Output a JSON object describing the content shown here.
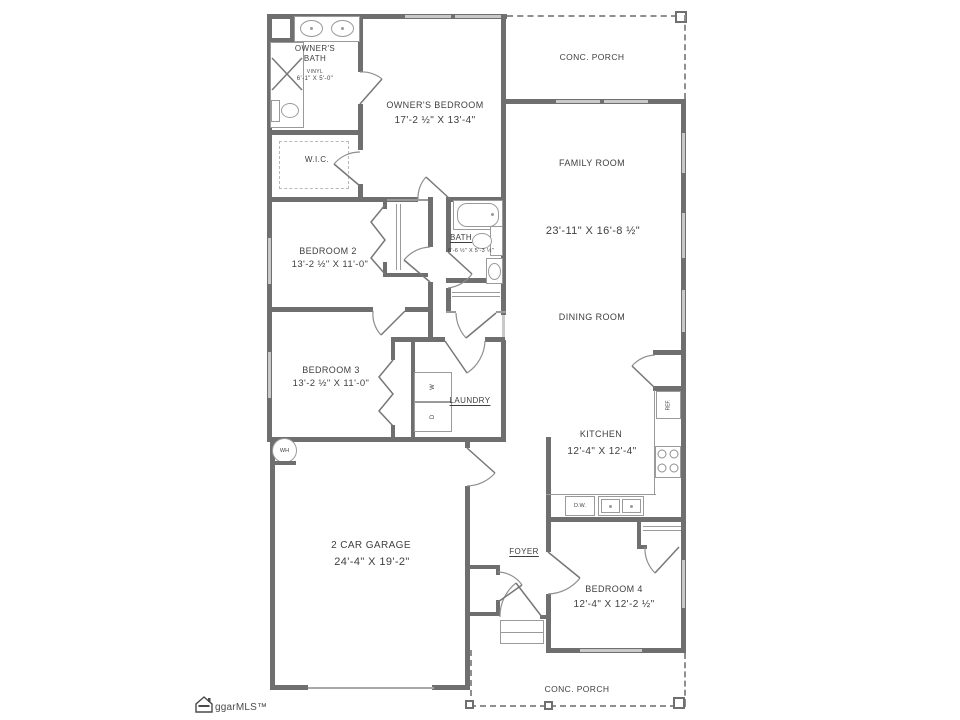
{
  "plan": {
    "rooms": {
      "owners_bath": {
        "name": "OWNER'S BATH",
        "floor": "VINYL",
        "dims": "6'-1\" X 5'-0\""
      },
      "owners_bedroom": {
        "name": "OWNER'S BEDROOM",
        "dims": "17'-2 ½\" X 13'-4\""
      },
      "porch_top": {
        "name": "CONC. PORCH"
      },
      "family_room": {
        "name": "FAMILY ROOM",
        "dims": "23'-11\" X 16'-8 ½\""
      },
      "wic": {
        "name": "W.I.C."
      },
      "bedroom2": {
        "name": "BEDROOM 2",
        "dims": "13'-2 ½\" X 11'-0\""
      },
      "bath": {
        "name": "BATH",
        "dims": "8'-6 ½\" X 5'-3 ½\""
      },
      "dining_room": {
        "name": "DINING ROOM"
      },
      "bedroom3": {
        "name": "BEDROOM 3",
        "dims": "13'-2 ½\" X 11'-0\""
      },
      "laundry": {
        "name": "LAUNDRY"
      },
      "kitchen": {
        "name": "KITCHEN",
        "dims": "12'-4\" X 12'-4\""
      },
      "garage": {
        "name": "2 CAR GARAGE",
        "dims": "24'-4\" X 19'-2\""
      },
      "foyer": {
        "name": "FOYER"
      },
      "bedroom4": {
        "name": "BEDROOM 4",
        "dims": "12'-4\" X 12'-2 ½\""
      },
      "porch_bottom": {
        "name": "CONC. PORCH"
      }
    },
    "fixtures": {
      "washer": "W",
      "dryer": "D",
      "dishwasher": "D.W.",
      "refrigerator": "REF.",
      "water_heater": "WH"
    },
    "watermark": "ggarMLS™",
    "colors": {
      "wall": "#6f6f6f",
      "thin_line": "#9a9a9a",
      "window": "#c9c9c9",
      "text": "#3f3f3f"
    }
  }
}
